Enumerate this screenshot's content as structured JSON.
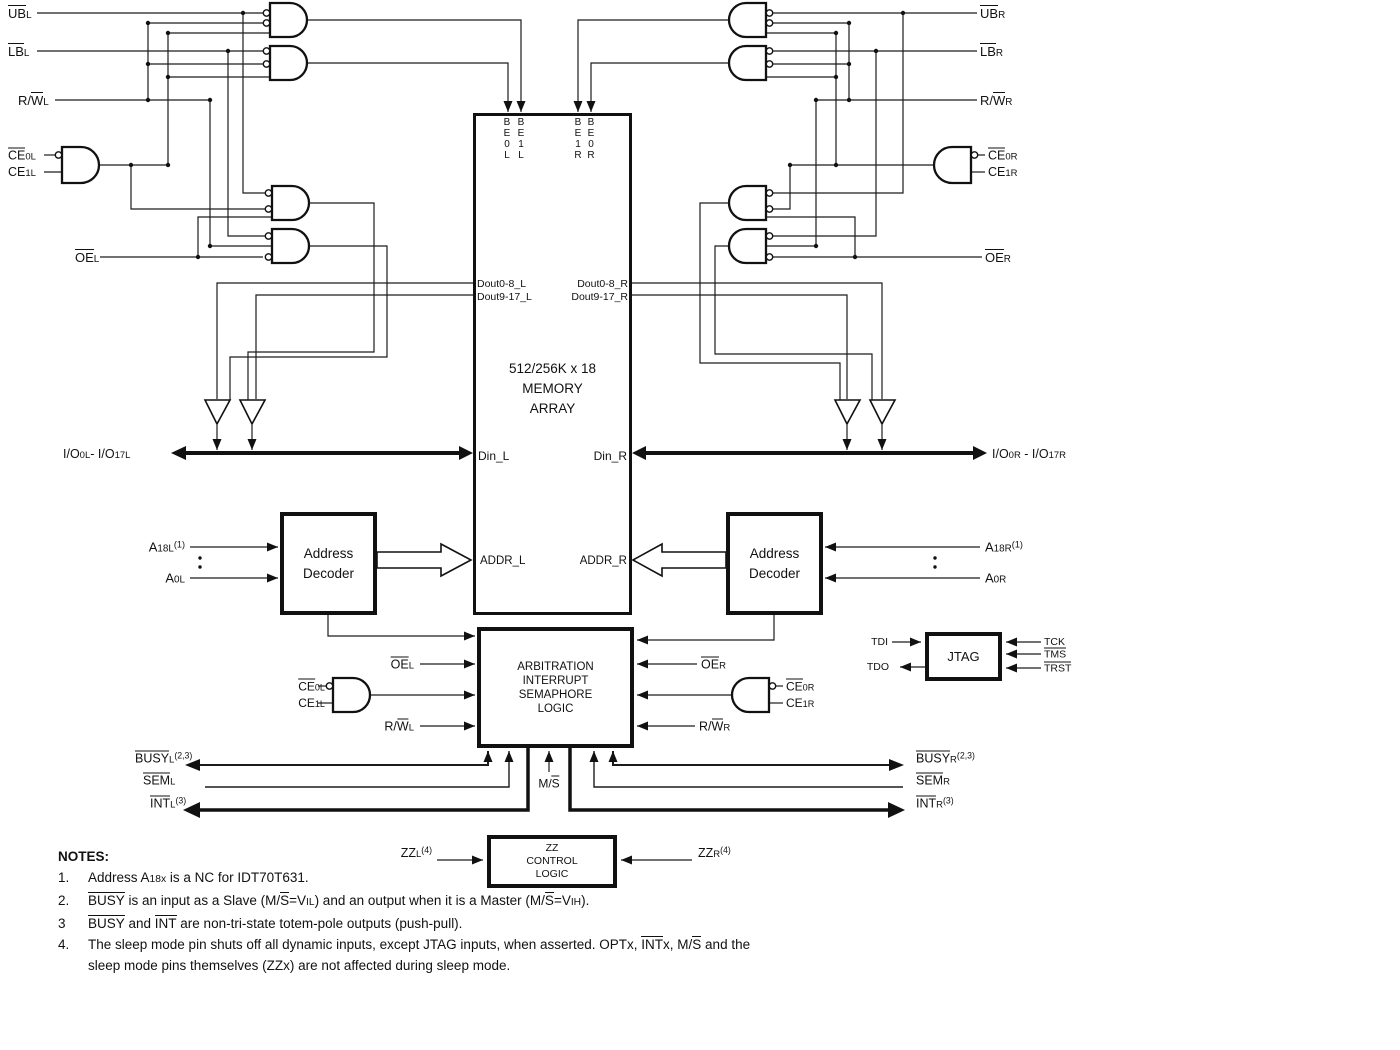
{
  "blocks": {
    "memory": {
      "line1": "512/256K x 18",
      "line2": "MEMORY",
      "line3": "ARRAY"
    },
    "decoder_left": {
      "line1": "Address",
      "line2": "Decoder"
    },
    "decoder_right": {
      "line1": "Address",
      "line2": "Decoder"
    },
    "arbitration": {
      "line1": "ARBITRATION",
      "line2": "INTERRUPT",
      "line3": "SEMAPHORE",
      "line4": "LOGIC"
    },
    "jtag": {
      "label": "JTAG"
    },
    "zz_control": {
      "line1": "ZZ",
      "line2": "CONTROL",
      "line3": "LOGIC"
    }
  },
  "colors": {
    "ink": "#111111",
    "wire": "#1c1c1c",
    "background": "#ffffff"
  },
  "labels": [
    {
      "n": "ubl-label",
      "x": 8,
      "y": 13,
      "a": "l",
      "fs": 13,
      "segs": [
        [
          "UB",
          "b"
        ],
        [
          "L",
          "s"
        ]
      ]
    },
    {
      "n": "lbl-label",
      "x": 8,
      "y": 51,
      "a": "l",
      "fs": 13,
      "segs": [
        [
          "LB",
          "b"
        ],
        [
          "L",
          "s"
        ]
      ]
    },
    {
      "n": "rwl-label",
      "x": 18,
      "y": 100,
      "a": "l",
      "fs": 13,
      "segs": [
        [
          "R/",
          ""
        ],
        [
          "W",
          "b"
        ],
        [
          "L",
          "s"
        ]
      ]
    },
    {
      "n": "ce0l-label",
      "x": 8,
      "y": 155,
      "a": "l",
      "fs": 12.5,
      "segs": [
        [
          "CE",
          "b"
        ],
        [
          "0L",
          "s"
        ]
      ]
    },
    {
      "n": "ce1l-label",
      "x": 8,
      "y": 172,
      "a": "l",
      "fs": 12.5,
      "segs": [
        [
          "CE",
          ""
        ],
        [
          "1L",
          "s"
        ]
      ]
    },
    {
      "n": "oel-label",
      "x": 75,
      "y": 257,
      "a": "l",
      "fs": 13,
      "segs": [
        [
          "OE",
          "b"
        ],
        [
          "L",
          "s"
        ]
      ]
    },
    {
      "n": "io-left-label",
      "x": 63,
      "y": 454,
      "a": "l",
      "fs": 12.5,
      "segs": [
        [
          "I/O",
          ""
        ],
        [
          "0L",
          "s"
        ],
        [
          "- I/O",
          ""
        ],
        [
          "17L",
          "s"
        ]
      ]
    },
    {
      "n": "a18l-label",
      "x": 185,
      "y": 547,
      "a": "r",
      "fs": 13,
      "segs": [
        [
          "A",
          ""
        ],
        [
          "18L",
          "s"
        ],
        [
          "(1)",
          "p"
        ]
      ]
    },
    {
      "n": "a0l-label",
      "x": 185,
      "y": 578,
      "a": "r",
      "fs": 13,
      "segs": [
        [
          "A",
          ""
        ],
        [
          "0L",
          "s"
        ]
      ]
    },
    {
      "n": "busyl-label",
      "x": 135,
      "y": 758,
      "a": "l",
      "fs": 12.5,
      "segs": [
        [
          "BUSY",
          "b"
        ],
        [
          "L",
          "s"
        ],
        [
          "(2,3)",
          "p"
        ]
      ]
    },
    {
      "n": "seml-label",
      "x": 143,
      "y": 780,
      "a": "l",
      "fs": 12.5,
      "segs": [
        [
          "SEM",
          "b"
        ],
        [
          "L",
          "s"
        ]
      ]
    },
    {
      "n": "intl-label",
      "x": 150,
      "y": 803,
      "a": "l",
      "fs": 12.5,
      "segs": [
        [
          "INT",
          "b"
        ],
        [
          "L",
          "s"
        ],
        [
          "(3)",
          "p"
        ]
      ]
    },
    {
      "n": "ubr-label",
      "x": 980,
      "y": 13,
      "a": "l",
      "fs": 13,
      "segs": [
        [
          "UB",
          "b"
        ],
        [
          "R",
          "s"
        ]
      ]
    },
    {
      "n": "lbr-label",
      "x": 980,
      "y": 51,
      "a": "l",
      "fs": 13,
      "segs": [
        [
          "LB",
          "b"
        ],
        [
          "R",
          "s"
        ]
      ]
    },
    {
      "n": "rwr-label",
      "x": 980,
      "y": 100,
      "a": "l",
      "fs": 13,
      "segs": [
        [
          "R/",
          ""
        ],
        [
          "W",
          "b"
        ],
        [
          "R",
          "s"
        ]
      ]
    },
    {
      "n": "ce0r-label",
      "x": 988,
      "y": 155,
      "a": "l",
      "fs": 12.5,
      "segs": [
        [
          "CE",
          "b"
        ],
        [
          "0R",
          "s"
        ]
      ]
    },
    {
      "n": "ce1r-label",
      "x": 988,
      "y": 172,
      "a": "l",
      "fs": 12.5,
      "segs": [
        [
          "CE",
          ""
        ],
        [
          "1R",
          "s"
        ]
      ]
    },
    {
      "n": "oer-label",
      "x": 985,
      "y": 257,
      "a": "l",
      "fs": 13,
      "segs": [
        [
          "OE",
          "b"
        ],
        [
          "R",
          "s"
        ]
      ]
    },
    {
      "n": "io-right-label",
      "x": 992,
      "y": 454,
      "a": "l",
      "fs": 12.5,
      "segs": [
        [
          "I/O",
          ""
        ],
        [
          "0R",
          "s"
        ],
        [
          " - I/O",
          ""
        ],
        [
          "17R",
          "s"
        ]
      ]
    },
    {
      "n": "a18r-label",
      "x": 985,
      "y": 547,
      "a": "l",
      "fs": 13,
      "segs": [
        [
          "A",
          ""
        ],
        [
          "18R",
          "s"
        ],
        [
          "(1)",
          "p"
        ]
      ]
    },
    {
      "n": "a0r-label",
      "x": 985,
      "y": 578,
      "a": "l",
      "fs": 13,
      "segs": [
        [
          "A",
          ""
        ],
        [
          "0R",
          "s"
        ]
      ]
    },
    {
      "n": "busyr-label",
      "x": 916,
      "y": 758,
      "a": "l",
      "fs": 12.5,
      "segs": [
        [
          "BUSY",
          "b"
        ],
        [
          "R",
          "s"
        ],
        [
          "(2,3)",
          "p"
        ]
      ]
    },
    {
      "n": "semr-label",
      "x": 916,
      "y": 780,
      "a": "l",
      "fs": 12.5,
      "segs": [
        [
          "SEM",
          "b"
        ],
        [
          "R",
          "s"
        ]
      ]
    },
    {
      "n": "intr-label",
      "x": 916,
      "y": 803,
      "a": "l",
      "fs": 12.5,
      "segs": [
        [
          "INT",
          "b"
        ],
        [
          "R",
          "s"
        ],
        [
          "(3)",
          "p"
        ]
      ]
    },
    {
      "n": "be0l-pin",
      "x": 507,
      "y": 117,
      "stack": 1,
      "fs": 10,
      "segs": [
        [
          "B"
        ],
        [
          "E"
        ],
        [
          "0"
        ],
        [
          "L"
        ]
      ]
    },
    {
      "n": "be1l-pin",
      "x": 521,
      "y": 117,
      "stack": 1,
      "fs": 10,
      "segs": [
        [
          "B"
        ],
        [
          "E"
        ],
        [
          "1"
        ],
        [
          "L"
        ]
      ]
    },
    {
      "n": "be1r-pin",
      "x": 578,
      "y": 117,
      "stack": 1,
      "fs": 10,
      "segs": [
        [
          "B"
        ],
        [
          "E"
        ],
        [
          "1"
        ],
        [
          "R"
        ]
      ]
    },
    {
      "n": "be0r-pin",
      "x": 591,
      "y": 117,
      "stack": 1,
      "fs": 10,
      "segs": [
        [
          "B"
        ],
        [
          "E"
        ],
        [
          "0"
        ],
        [
          "R"
        ]
      ]
    },
    {
      "n": "dout0-8l-pin",
      "x": 477,
      "y": 284,
      "a": "l",
      "fs": 10.5,
      "segs": [
        [
          "Dout0-8_L",
          ""
        ]
      ]
    },
    {
      "n": "dout9-17l-pin",
      "x": 477,
      "y": 297,
      "a": "l",
      "fs": 10.5,
      "segs": [
        [
          "Dout9-17_L",
          ""
        ]
      ]
    },
    {
      "n": "dout0-8r-pin",
      "x": 628,
      "y": 284,
      "a": "r",
      "fs": 10.5,
      "segs": [
        [
          "Dout0-8_R",
          ""
        ]
      ]
    },
    {
      "n": "dout9-17r-pin",
      "x": 628,
      "y": 297,
      "a": "r",
      "fs": 10.5,
      "segs": [
        [
          "Dout9-17_R",
          ""
        ]
      ]
    },
    {
      "n": "din-l-pin",
      "x": 478,
      "y": 456,
      "a": "l",
      "fs": 12,
      "segs": [
        [
          "Din_L",
          ""
        ]
      ]
    },
    {
      "n": "din-r-pin",
      "x": 627,
      "y": 456,
      "a": "r",
      "fs": 12,
      "segs": [
        [
          "Din_R",
          ""
        ]
      ]
    },
    {
      "n": "addr-l-pin",
      "x": 480,
      "y": 561,
      "a": "l",
      "fs": 11.5,
      "segs": [
        [
          "ADDR_L",
          ""
        ]
      ]
    },
    {
      "n": "addr-r-pin",
      "x": 627,
      "y": 561,
      "a": "r",
      "fs": 11.5,
      "segs": [
        [
          "ADDR_R",
          ""
        ]
      ]
    },
    {
      "n": "oel-arb-label",
      "x": 414,
      "y": 664,
      "a": "r",
      "fs": 12.5,
      "segs": [
        [
          "OE",
          "b"
        ],
        [
          "L",
          "s"
        ]
      ]
    },
    {
      "n": "ce0l-arb-label",
      "x": 325,
      "y": 686,
      "a": "r",
      "fs": 12,
      "segs": [
        [
          "CE",
          "b"
        ],
        [
          "0L",
          "s"
        ]
      ]
    },
    {
      "n": "ce1l-arb-label",
      "x": 325,
      "y": 703,
      "a": "r",
      "fs": 12,
      "segs": [
        [
          "CE",
          ""
        ],
        [
          "1L",
          "s"
        ]
      ]
    },
    {
      "n": "rwl-arb-label",
      "x": 414,
      "y": 726,
      "a": "r",
      "fs": 12.5,
      "segs": [
        [
          "R/",
          ""
        ],
        [
          "W",
          "b"
        ],
        [
          "L",
          "s"
        ]
      ]
    },
    {
      "n": "oer-arb-label",
      "x": 701,
      "y": 664,
      "a": "l",
      "fs": 12.5,
      "segs": [
        [
          "OE",
          "b"
        ],
        [
          "R",
          "s"
        ]
      ]
    },
    {
      "n": "ce0r-arb-label",
      "x": 786,
      "y": 686,
      "a": "l",
      "fs": 12,
      "segs": [
        [
          "CE",
          "b"
        ],
        [
          "0R",
          "s"
        ]
      ]
    },
    {
      "n": "ce1r-arb-label",
      "x": 786,
      "y": 703,
      "a": "l",
      "fs": 12,
      "segs": [
        [
          "CE",
          ""
        ],
        [
          "1R",
          "s"
        ]
      ]
    },
    {
      "n": "rwr-arb-label",
      "x": 699,
      "y": 726,
      "a": "l",
      "fs": 12.5,
      "segs": [
        [
          "R/",
          ""
        ],
        [
          "W",
          "b"
        ],
        [
          "R",
          "s"
        ]
      ]
    },
    {
      "n": "ms-label",
      "x": 549,
      "y": 783,
      "a": "c",
      "fs": 12,
      "segs": [
        [
          "M/",
          ""
        ],
        [
          "S",
          "b"
        ]
      ]
    },
    {
      "n": "tdi-label",
      "x": 888,
      "y": 642,
      "a": "r",
      "fs": 10.5,
      "segs": [
        [
          "TDI",
          ""
        ]
      ]
    },
    {
      "n": "tdo-label",
      "x": 889,
      "y": 667,
      "a": "r",
      "fs": 10.5,
      "segs": [
        [
          "TDO",
          ""
        ]
      ]
    },
    {
      "n": "tck-label",
      "x": 1044,
      "y": 642,
      "a": "l",
      "fs": 10.5,
      "segs": [
        [
          "TCK",
          ""
        ]
      ]
    },
    {
      "n": "tms-label",
      "x": 1044,
      "y": 654,
      "a": "l",
      "fs": 10.5,
      "segs": [
        [
          "TMS",
          "b"
        ]
      ]
    },
    {
      "n": "trst-label",
      "x": 1044,
      "y": 668,
      "a": "l",
      "fs": 10.5,
      "segs": [
        [
          "TRST",
          "b"
        ]
      ]
    },
    {
      "n": "zzl-label",
      "x": 432,
      "y": 853,
      "a": "r",
      "fs": 12.5,
      "segs": [
        [
          "ZZ",
          ""
        ],
        [
          "L",
          "s"
        ],
        [
          "(4)",
          "p"
        ]
      ]
    },
    {
      "n": "zzr-label",
      "x": 698,
      "y": 853,
      "a": "l",
      "fs": 12.5,
      "segs": [
        [
          "ZZ",
          ""
        ],
        [
          "R",
          "s"
        ],
        [
          "(4)",
          "p"
        ]
      ]
    }
  ],
  "notes": {
    "heading": "NOTES:",
    "items": [
      {
        "num": "1.",
        "lines": [
          [
            [
              "Address A",
              ""
            ],
            [
              "18x",
              "s"
            ],
            [
              " is a NC for IDT70T631.",
              ""
            ]
          ]
        ]
      },
      {
        "num": "2.",
        "lines": [
          [
            [
              "BUSY",
              "b"
            ],
            [
              " is an input as a Slave (M/",
              ""
            ],
            [
              "S",
              "b"
            ],
            [
              "=V",
              ""
            ],
            [
              "IL",
              "s"
            ],
            [
              ") and an output when it is a Master (M/",
              ""
            ],
            [
              "S",
              "b"
            ],
            [
              "=V",
              ""
            ],
            [
              "IH",
              "s"
            ],
            [
              ").",
              ""
            ]
          ]
        ]
      },
      {
        "num": "3",
        "lines": [
          [
            [
              "BUSY",
              "b"
            ],
            [
              " and ",
              ""
            ],
            [
              "INT",
              "b"
            ],
            [
              " are non-tri-state totem-pole outputs (push-pull).",
              ""
            ]
          ]
        ]
      },
      {
        "num": "4.",
        "lines": [
          [
            [
              "The sleep mode pin shuts off all dynamic inputs, except JTAG inputs, when asserted. OPTx, ",
              ""
            ],
            [
              "INT",
              "b"
            ],
            [
              "x",
              ""
            ],
            [
              ", M/",
              ""
            ],
            [
              "S",
              "b"
            ],
            [
              " and the",
              ""
            ]
          ],
          [
            [
              "sleep mode pins themselves (ZZx) are not affected during sleep mode.",
              ""
            ]
          ]
        ]
      }
    ]
  }
}
